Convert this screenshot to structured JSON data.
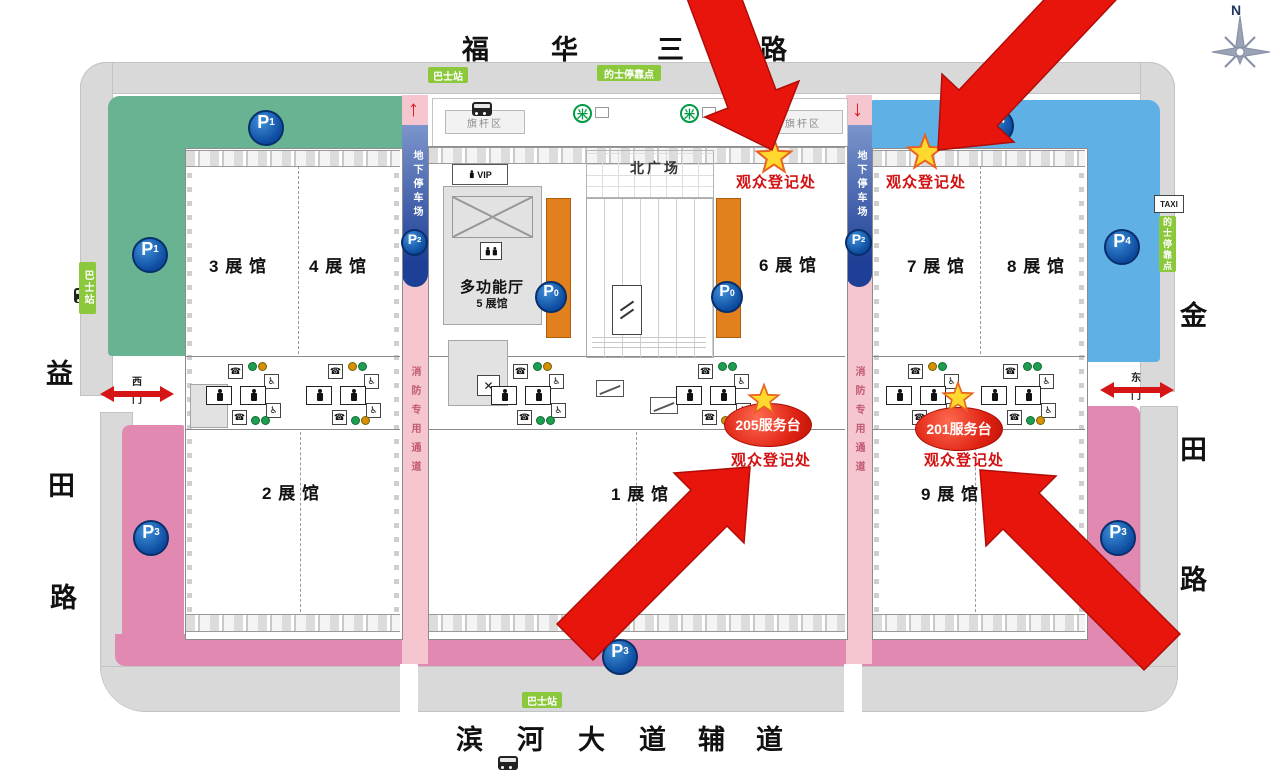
{
  "roads": {
    "top_chars": [
      "福",
      "华",
      "三",
      "路"
    ],
    "bottom_chars": [
      "滨",
      "河",
      "大",
      "道",
      "辅",
      "道"
    ],
    "left_chars": [
      "益",
      "田",
      "路"
    ],
    "right_chars": [
      "金",
      "田",
      "路"
    ]
  },
  "halls": {
    "h3": "3 展 馆",
    "h4": "4 展 馆",
    "h6": "6 展 馆",
    "h7": "7 展 馆",
    "h8": "8 展 馆",
    "h2": "2 展 馆",
    "h1": "1 展 馆",
    "h9": "9 展 馆",
    "multi": "多功能厅",
    "multi_sub": "5 展馆"
  },
  "registration": {
    "label": "观众登记处",
    "desk_205": "205服务台",
    "desk_201": "201服务台"
  },
  "parking": {
    "letter": "P",
    "n0": "0",
    "n1": "1",
    "n2": "2",
    "n3": "3",
    "n4": "4"
  },
  "transit": {
    "bus_station": "巴士站",
    "taxi_stop": "的士停靠点",
    "taxi_en": "TAXI"
  },
  "areas": {
    "north_square": "北广场",
    "flag_area": "旗杆区",
    "underground": "地下停车场",
    "fire_lane": "消防专用通道",
    "vip": "VIP"
  },
  "gates": {
    "west_top": "西",
    "west_bottom": "门",
    "east_top": "东",
    "east_bottom": "门"
  },
  "compass": {
    "north": "N"
  },
  "icons": {
    "phone": "☎",
    "wheelchair": "♿",
    "cross": "✕",
    "metro": "米",
    "up_arrow": "↑",
    "down_arrow": "↓"
  },
  "colors": {
    "p1_green": "#68b391",
    "p4_blue": "#5fb0e5",
    "p3_pink": "#e289b2",
    "fire_pink": "#f5c6cf",
    "underground_blue": "#1e3f96",
    "orange": "#e2801e",
    "arrow_red": "#e8150d",
    "star_yellow": "#ffd92e",
    "reg_red": "#d41414",
    "label_green": "#8cc83c"
  }
}
